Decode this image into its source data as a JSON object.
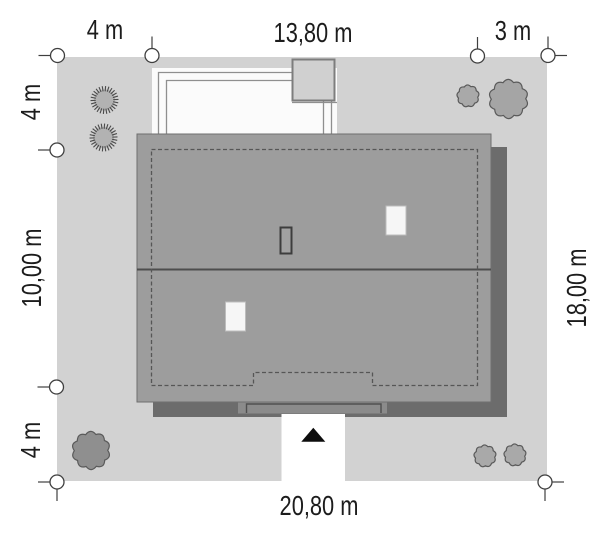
{
  "title": "House site plan",
  "dimensions": {
    "top": [
      "4 m",
      "13,80 m",
      "3 m"
    ],
    "left": [
      "4 m",
      "10,00 m",
      "4 m"
    ],
    "right": [
      "18,00 m"
    ],
    "bottom": [
      "20,80 m"
    ]
  },
  "colors": {
    "plot": "#d2d2d2",
    "roof": "#9d9d9d",
    "roof_shadow": "#6c6c6c",
    "terrace_band": "#8b8b8b",
    "shed": "#d0d0d0",
    "skylight": "#f6f6f6",
    "label_text": "#1c1c1c",
    "tree_stroke": "#4a4a4a",
    "marker_stroke": "#3f3f3f"
  },
  "site": {
    "plot_size_px": {
      "x": 57,
      "y": 57,
      "w": 490,
      "h": 424
    },
    "skylights": [
      {
        "x": 386,
        "y": 206,
        "w": 20,
        "h": 29
      },
      {
        "x": 225.5,
        "y": 302,
        "w": 20,
        "h": 29
      }
    ],
    "trees": [
      {
        "type": "conifer",
        "x": 104.5,
        "y": 100,
        "r": 12.5,
        "fill": "#b2b2b2"
      },
      {
        "type": "conifer",
        "x": 103.5,
        "y": 137.5,
        "r": 12.5,
        "fill": "#b2b2b2"
      },
      {
        "type": "lobed",
        "x": 468,
        "y": 96,
        "r": 10.5,
        "lobes": 9,
        "fill": "#a9a9a9"
      },
      {
        "type": "lobed",
        "x": 508.5,
        "y": 99,
        "r": 18.5,
        "lobes": 10,
        "fill": "#a5a5a5"
      },
      {
        "type": "lobed",
        "x": 91,
        "y": 450.5,
        "r": 18,
        "lobes": 10,
        "fill": "#8f8f8f"
      },
      {
        "type": "lobed",
        "x": 485,
        "y": 456,
        "r": 10.5,
        "lobes": 9,
        "fill": "#a9a9a9"
      },
      {
        "type": "lobed",
        "x": 515,
        "y": 455,
        "r": 10.5,
        "lobes": 9,
        "fill": "#a9a9a9"
      }
    ],
    "markers": [
      {
        "x": 57.5,
        "y": 55.5,
        "ticks": [
          "left"
        ]
      },
      {
        "x": 152,
        "y": 55.5,
        "ticks": [
          "up"
        ]
      },
      {
        "x": 477.5,
        "y": 56,
        "ticks": [
          "up"
        ]
      },
      {
        "x": 548,
        "y": 55.5,
        "ticks": [
          "up",
          "right"
        ]
      },
      {
        "x": 57,
        "y": 150,
        "ticks": [
          "left"
        ]
      },
      {
        "x": 56.5,
        "y": 387,
        "ticks": [
          "left"
        ]
      },
      {
        "x": 57,
        "y": 482,
        "ticks": [
          "left",
          "down"
        ]
      },
      {
        "x": 545,
        "y": 482,
        "ticks": [
          "right",
          "down"
        ]
      }
    ]
  }
}
